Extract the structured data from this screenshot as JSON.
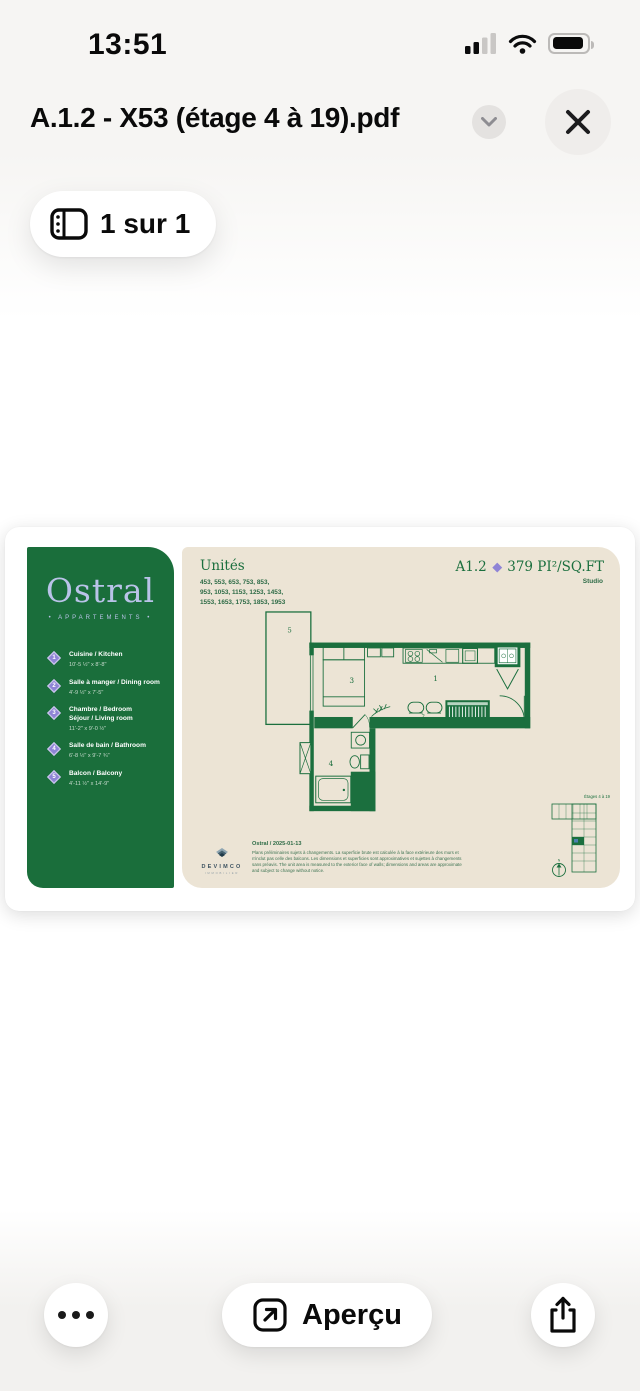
{
  "status_bar": {
    "time": "13:51"
  },
  "header": {
    "title": "A.1.2 - X53 (étage 4 à 19).pdf"
  },
  "page_indicator": {
    "label": "1 sur 1"
  },
  "pdf": {
    "brand": {
      "name": "Ostral",
      "tagline": "• APPARTEMENTS •"
    },
    "legend": [
      {
        "num": "1",
        "title": "Cuisine / Kitchen",
        "title2": "",
        "dims": "10'-5 ½\" x 8'-8\""
      },
      {
        "num": "2",
        "title": "Salle à manger / Dining room",
        "title2": "",
        "dims": "4'-9 ½\" x 7'-5\""
      },
      {
        "num": "3",
        "title": "Chambre / Bedroom",
        "title2": "Séjour / Living room",
        "dims": "11'-2\" x 9'-0 ½\""
      },
      {
        "num": "4",
        "title": "Salle de bain / Bathroom",
        "title2": "",
        "dims": "6'-8 ½\" x 9'-7 ¾\""
      },
      {
        "num": "5",
        "title": "Balcon / Balcony",
        "title2": "",
        "dims": "4'-11 ½\" x 14'-9\""
      }
    ],
    "unites": {
      "heading": "Unités",
      "line1": "453, 553, 653, 753, 853,",
      "line2": "953, 1053, 1153, 1253, 1453,",
      "line3": "1553, 1653, 1753, 1853, 1953"
    },
    "plan_code": "A1.2",
    "plan_area": "379 PI²/SQ.FT",
    "unit_type": "Studio",
    "rooms": [
      "1",
      "2",
      "3",
      "4",
      "5"
    ],
    "key_plan_label": "Étages 4 à 19",
    "devimco": {
      "name": "DEVIMCO",
      "division": "IMMOBILIER"
    },
    "date_line": "Ostral / 2025-01-13",
    "disclaimer": "Plans préliminaires sujets à changements. La superficie brute est calculée à la face extérieure des murs et n'inclut pas celle des balcons. Les dimensions et superficies sont approximatives et sujettes à changements sans préavis. The unit area is measured to the exterior face of walls; dimensions and areas are approximate and subject to change without notice."
  },
  "toolbar": {
    "preview_label": "Aperçu"
  },
  "icons": {
    "pages": "sidebar-pages",
    "chevron": "chevron-down",
    "close": "x",
    "more": "ellipsis",
    "preview": "arrow-up-right-square",
    "share": "share-up",
    "compass": "north-arrow"
  },
  "colors": {
    "brand_green": "#1a6e3b",
    "beige": "#ece4d5",
    "lavender": "#b9c3e8",
    "accent_purple": "#8f84d6"
  }
}
